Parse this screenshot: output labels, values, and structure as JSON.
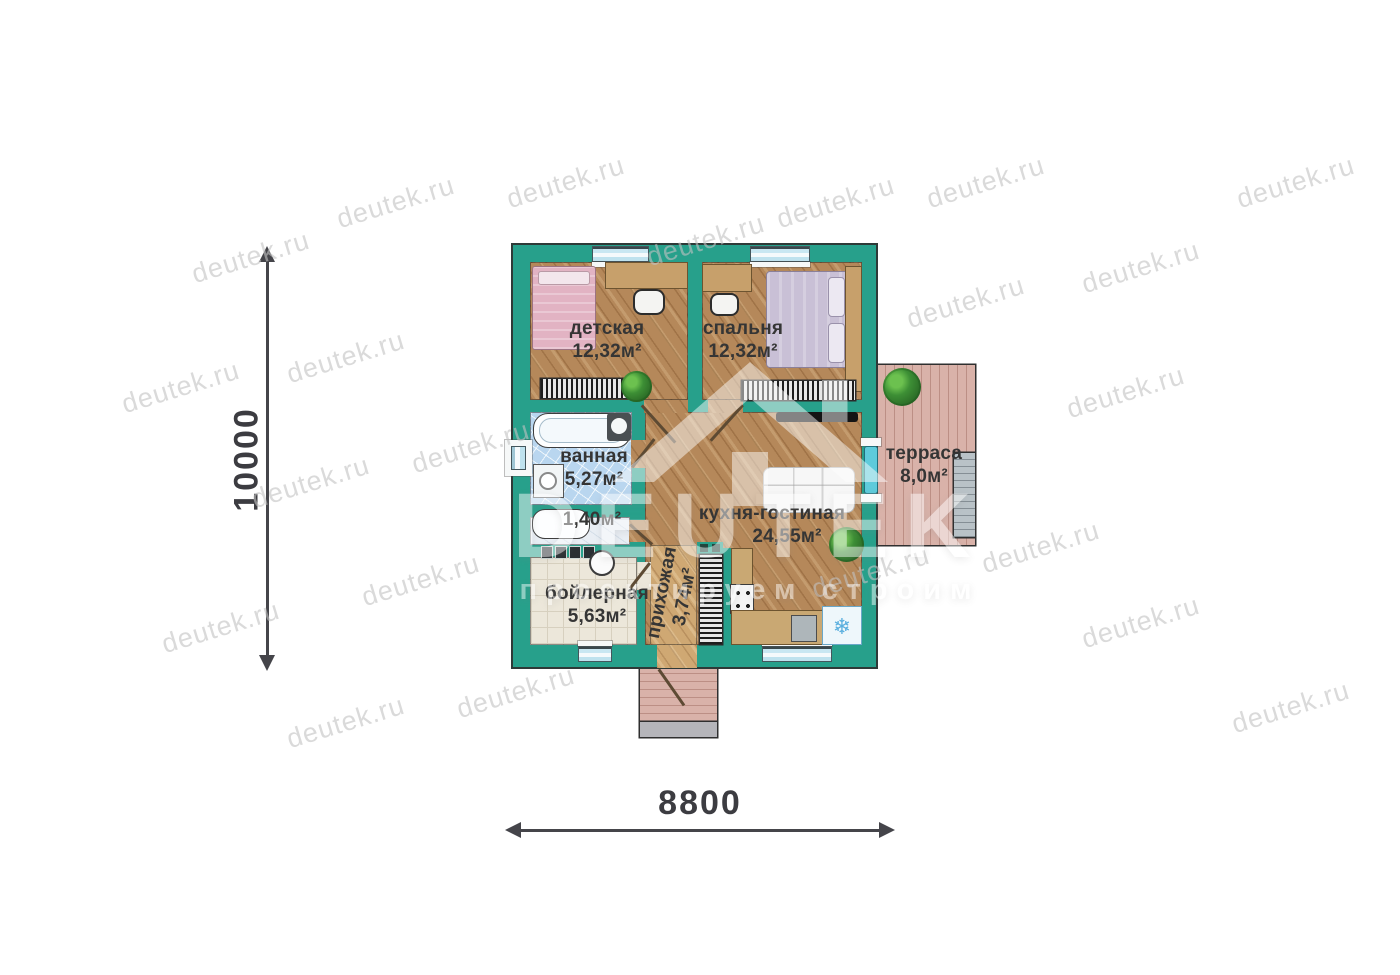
{
  "watermark": {
    "text": "deutek.ru"
  },
  "logo": {
    "name": "DEUTEK",
    "tagline": "проектируем строим"
  },
  "dimensions": {
    "height": "10000",
    "width": "8800"
  },
  "rooms": {
    "nursery": {
      "name": "детская",
      "area": "12,32м²"
    },
    "bedroom": {
      "name": "спальня",
      "area": "12,32м²"
    },
    "bathroom": {
      "name": "ванная",
      "area": "5,27м²"
    },
    "wc": {
      "area": "1,40м²"
    },
    "boiler": {
      "name": "бойлерная",
      "area": "5,63м²"
    },
    "hallway": {
      "name": "прихожая",
      "area": "3,74м²"
    },
    "kitchen": {
      "name": "кухня-гостиная",
      "area": "24,55м²"
    },
    "terrace": {
      "name": "терраса",
      "area": "8,0м²"
    }
  },
  "colors": {
    "wall": "#27a08b",
    "wood_floor": "#b5885a",
    "hall_floor": "#cfa873",
    "bath_tile": "#b9d6ef",
    "boiler_tile": "#ece7da",
    "terrace_deck": "#d9b2a9",
    "terrace_door": "#5ecbdb",
    "dimension_text": "#3c3c41",
    "watermark_grey": "#c2c2c2"
  }
}
